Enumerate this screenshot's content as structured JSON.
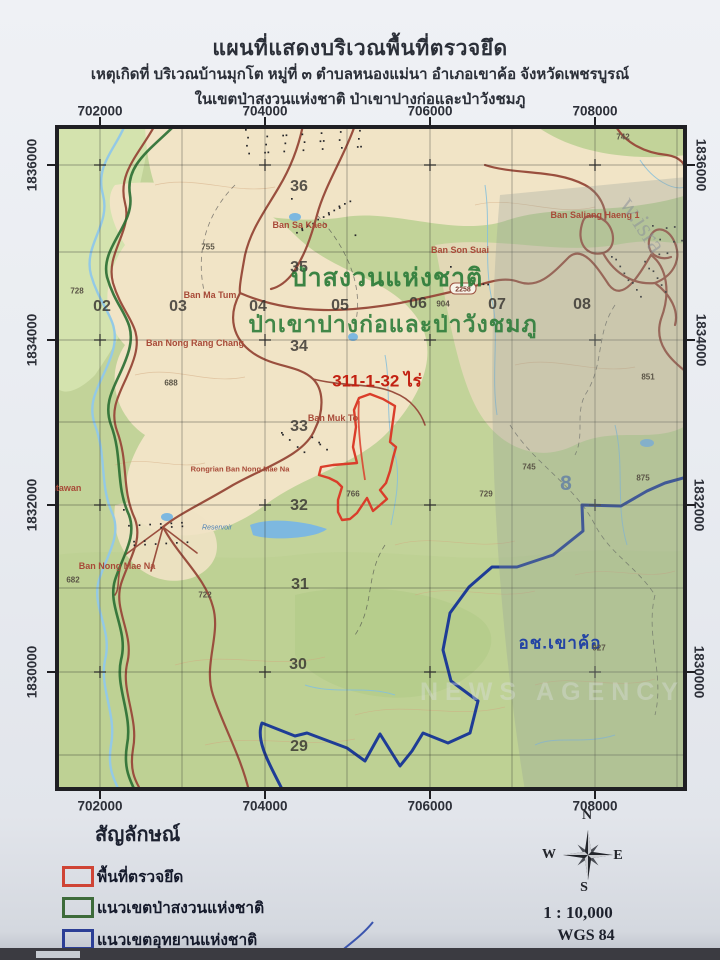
{
  "header": {
    "title": "แผนที่แสดงบริเวณพื้นที่ตรวจยึด",
    "subtitle": "เหตุเกิดที่ บริเวณบ้านมุกโต หมู่ที่ ๓ ตำบลหนองแม่นา อำเภอเขาค้อ จังหวัดเพชรบูรณ์",
    "subtitle2": "ในเขตป่าสงวนแห่งชาติ ป่าเขาปางก่อและป่าวังชมภู"
  },
  "map": {
    "grid": {
      "eastings": [
        "702000",
        "704000",
        "706000",
        "708000"
      ],
      "northings": [
        "1836000",
        "1834000",
        "1832000",
        "1830000"
      ],
      "row_numbers": [
        "36",
        "35",
        "34",
        "33",
        "32",
        "31",
        "30",
        "29"
      ],
      "col_numbers": [
        "02",
        "03",
        "04",
        "05",
        "06",
        "07",
        "08"
      ],
      "zone_digit": "8"
    },
    "labels": {
      "forest_reserve_name": "ป่าสงวนแห่งชาติ",
      "forest_reserve_name2": "ป่าเขาปางก่อและป่าวังชมภู",
      "seized_area": "311-1-32 ไร่",
      "national_park_abbr": "อช.เขาค้อ",
      "road_number": "2258",
      "reservoir": "Reservoir"
    },
    "villages": [
      "Ban Sa Kaeo",
      "Ban Ma Tum",
      "Ban Nong Rang Chang",
      "Ban Son Suai",
      "Ban Saliang Haeng 1",
      "Ban Muk To",
      "Ban Nong Mae Na",
      "Rongrian Ban Nong Mae Na",
      "Tantawan"
    ],
    "elevations": [
      "728",
      "755",
      "688",
      "682",
      "722",
      "745",
      "729",
      "766",
      "851",
      "875",
      "904",
      "927",
      "742"
    ],
    "colors": {
      "seized_outline": "#d63c2a",
      "forest_boundary": "#2c7034",
      "park_boundary": "#1e3c96",
      "road": "#9a4f3e",
      "water": "#8fc6e4"
    }
  },
  "watermark": {
    "diagonal": "w.isra",
    "bottom": "NEWS AGENCY"
  },
  "legend": {
    "heading": "สัญลักษณ์",
    "items": [
      {
        "label": "พื้นที่ตรวจยึด",
        "color": "#cf4435"
      },
      {
        "label": "แนวเขตป่าสงวนแห่งชาติ",
        "color": "#3d6b3a"
      },
      {
        "label": "แนวเขตอุทยานแห่งชาติ",
        "color": "#2c3f96"
      }
    ]
  },
  "compass": {
    "n": "N",
    "e": "E",
    "s": "S",
    "w": "W"
  },
  "footer": {
    "scale": "1 : 10,000",
    "datum": "WGS 84"
  }
}
